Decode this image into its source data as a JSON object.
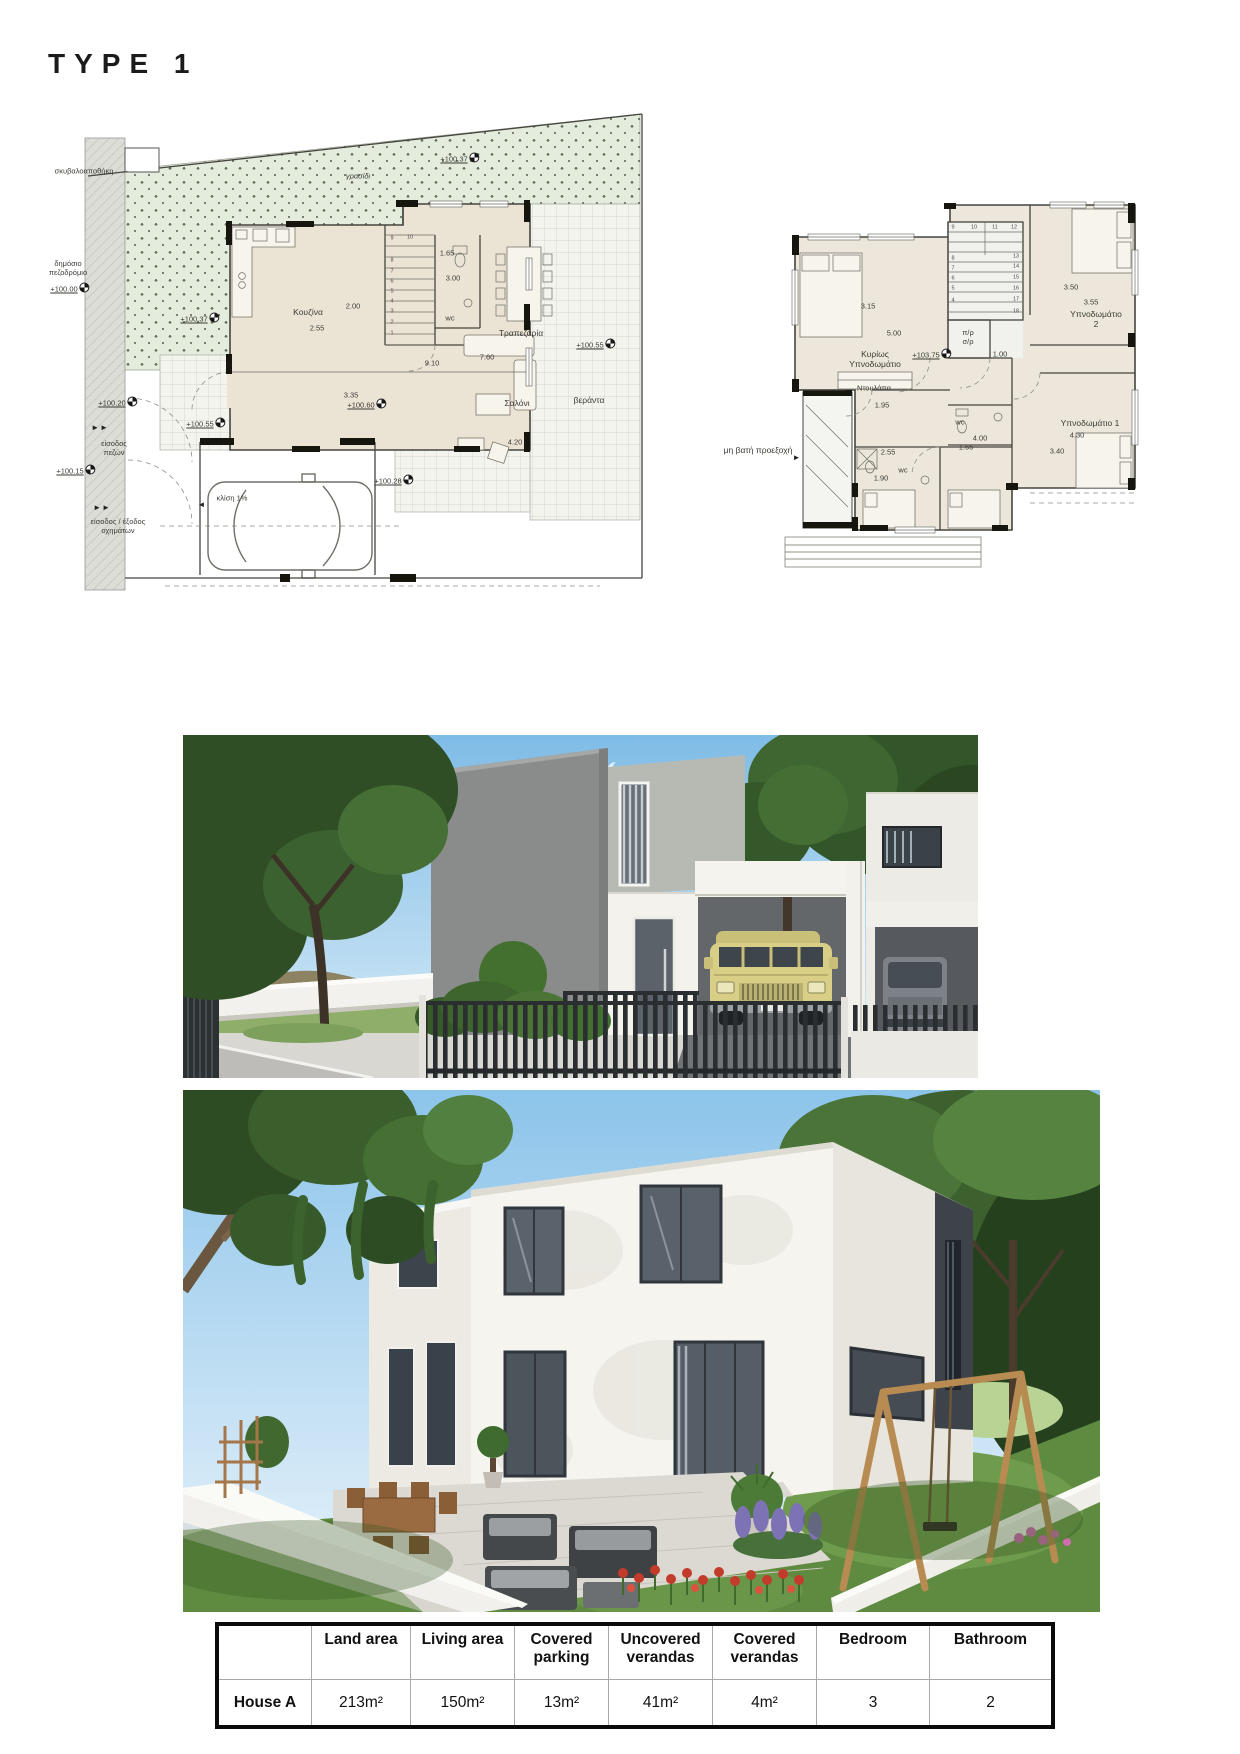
{
  "title": "TYPE 1",
  "colors": {
    "grass_fill": "#e3ecdd",
    "plan_floor": "#ebe4d5",
    "sidewalk_gray": "#ddddd8",
    "sky_top": "#7fbce6",
    "sky_bottom": "#d9ecf8",
    "facade_gray": "#898c8b",
    "facade_white": "#f3f2ed",
    "suv_yellow": "#d8ce85",
    "fence_dark": "#2a2e31",
    "lawn_green": "#5e8b40",
    "tulip_red": "#c33b2b",
    "lavender_purple": "#7d72b4",
    "table_border": "#0a0a0a"
  },
  "icons": {
    "level_marker": "quartered-circle"
  },
  "plans": {
    "ground": {
      "annotations": [
        {
          "t": "σκυβαλοαποθήκη",
          "x": 44,
          "y": 63
        },
        {
          "t": "→",
          "x": 86,
          "y": 63,
          "cls": "arr"
        },
        {
          "t": "δημόσιο\nπεζοδρόμιο",
          "x": 28,
          "y": 160
        },
        {
          "t": "+100.00",
          "x": 30,
          "y": 180,
          "lvl": true
        },
        {
          "t": "+100.37",
          "x": 160,
          "y": 210,
          "lvl": true
        },
        {
          "t": "γρασίδι",
          "x": 318,
          "y": 68,
          "cls": "t7i"
        },
        {
          "t": "+100.37",
          "x": 420,
          "y": 50,
          "lvl": true
        },
        {
          "t": "+100.20",
          "x": 78,
          "y": 294,
          "lvl": true
        },
        {
          "t": "►►",
          "x": 60,
          "y": 320,
          "cls": "arr"
        },
        {
          "t": "είσοδος\nπεζών",
          "x": 74,
          "y": 340
        },
        {
          "t": "+100.15",
          "x": 36,
          "y": 362,
          "lvl": true
        },
        {
          "t": "►►",
          "x": 62,
          "y": 400,
          "cls": "arr"
        },
        {
          "t": "είσοδος / έξοδος\nοχημάτων",
          "x": 78,
          "y": 418
        },
        {
          "t": "Κουζίνα",
          "x": 268,
          "y": 204,
          "cls": "t8"
        },
        {
          "t": "2.55",
          "x": 277,
          "y": 220
        },
        {
          "t": "2.00",
          "x": 313,
          "y": 198
        },
        {
          "t": "1.65",
          "x": 407,
          "y": 145
        },
        {
          "t": "3.00",
          "x": 413,
          "y": 170
        },
        {
          "t": "wc",
          "x": 410,
          "y": 210
        },
        {
          "t": "Τραπεζαρία",
          "x": 481,
          "y": 225,
          "cls": "t8"
        },
        {
          "t": "9.10",
          "x": 392,
          "y": 255
        },
        {
          "t": "7.60",
          "x": 447,
          "y": 249
        },
        {
          "t": "3.35",
          "x": 311,
          "y": 287
        },
        {
          "t": "+100.60",
          "x": 327,
          "y": 296,
          "lvl": true
        },
        {
          "t": "Σαλόνι",
          "x": 477,
          "y": 295,
          "cls": "t8"
        },
        {
          "t": "4.20",
          "x": 475,
          "y": 334
        },
        {
          "t": "+100.55",
          "x": 556,
          "y": 236,
          "lvl": true
        },
        {
          "t": "βεράντα",
          "x": 549,
          "y": 292,
          "cls": "t8"
        },
        {
          "t": "+100.55",
          "x": 166,
          "y": 315,
          "lvl": true
        },
        {
          "t": "+100.28",
          "x": 354,
          "y": 372,
          "lvl": true
        },
        {
          "t": "κλίση 1%",
          "x": 192,
          "y": 390
        },
        {
          "t": "◄",
          "x": 162,
          "y": 397,
          "cls": "arr"
        },
        {
          "t": "9",
          "x": 352,
          "y": 131,
          "cls": "t5"
        },
        {
          "t": "10",
          "x": 370,
          "y": 130,
          "cls": "t5"
        },
        {
          "t": "8",
          "x": 352,
          "y": 153,
          "cls": "t5"
        },
        {
          "t": "7",
          "x": 352,
          "y": 164,
          "cls": "t5"
        },
        {
          "t": "6",
          "x": 352,
          "y": 174,
          "cls": "t5"
        },
        {
          "t": "5",
          "x": 352,
          "y": 184,
          "cls": "t5"
        },
        {
          "t": "4",
          "x": 352,
          "y": 194,
          "cls": "t5"
        },
        {
          "t": "3",
          "x": 352,
          "y": 204,
          "cls": "t5"
        },
        {
          "t": "2",
          "x": 352,
          "y": 215,
          "cls": "t5"
        },
        {
          "t": "1",
          "x": 352,
          "y": 226,
          "cls": "t5"
        }
      ]
    },
    "first": {
      "annotations": [
        {
          "t": "3.15",
          "x": 168,
          "y": 111
        },
        {
          "t": "5.00",
          "x": 194,
          "y": 138
        },
        {
          "t": "Κυρίως\nΥπνοδωμάτιο",
          "x": 175,
          "y": 164,
          "cls": "t8"
        },
        {
          "t": "π/ρ\nσ/ρ",
          "x": 268,
          "y": 142
        },
        {
          "t": "+103.75",
          "x": 232,
          "y": 159,
          "lvl": true
        },
        {
          "t": "1.00",
          "x": 300,
          "y": 159
        },
        {
          "t": "3.50",
          "x": 371,
          "y": 92
        },
        {
          "t": "3.55",
          "x": 391,
          "y": 107
        },
        {
          "t": "Υπνοδωμάτιο 2",
          "x": 396,
          "y": 124,
          "cls": "t8"
        },
        {
          "t": "Ντουλάπα",
          "x": 174,
          "y": 193
        },
        {
          "t": "1.95",
          "x": 182,
          "y": 210
        },
        {
          "t": "wc",
          "x": 260,
          "y": 227
        },
        {
          "t": "4.00",
          "x": 280,
          "y": 243
        },
        {
          "t": "1.65",
          "x": 266,
          "y": 252
        },
        {
          "t": "2.55",
          "x": 188,
          "y": 257
        },
        {
          "t": "wc",
          "x": 203,
          "y": 275
        },
        {
          "t": "1.90",
          "x": 181,
          "y": 283
        },
        {
          "t": "Υπνοδωμάτιο 1",
          "x": 390,
          "y": 228,
          "cls": "t8"
        },
        {
          "t": "4.30",
          "x": 377,
          "y": 240
        },
        {
          "t": "3.40",
          "x": 357,
          "y": 256
        },
        {
          "t": "μη βατή προεξοχή",
          "x": 58,
          "y": 255,
          "cls": "t8"
        },
        {
          "t": "►",
          "x": 97,
          "y": 263,
          "cls": "arr"
        },
        {
          "t": "9",
          "x": 253,
          "y": 33,
          "cls": "t5"
        },
        {
          "t": "10",
          "x": 274,
          "y": 33,
          "cls": "t5"
        },
        {
          "t": "11",
          "x": 295,
          "y": 33,
          "cls": "t5"
        },
        {
          "t": "12",
          "x": 314,
          "y": 33,
          "cls": "t5"
        },
        {
          "t": "8",
          "x": 253,
          "y": 64,
          "cls": "t5"
        },
        {
          "t": "7",
          "x": 253,
          "y": 74,
          "cls": "t5"
        },
        {
          "t": "6",
          "x": 253,
          "y": 84,
          "cls": "t5"
        },
        {
          "t": "5",
          "x": 253,
          "y": 94,
          "cls": "t5"
        },
        {
          "t": "4",
          "x": 253,
          "y": 106,
          "cls": "t5"
        },
        {
          "t": "13",
          "x": 316,
          "y": 62,
          "cls": "t5"
        },
        {
          "t": "14",
          "x": 316,
          "y": 72,
          "cls": "t5"
        },
        {
          "t": "15",
          "x": 316,
          "y": 83,
          "cls": "t5"
        },
        {
          "t": "16",
          "x": 316,
          "y": 94,
          "cls": "t5"
        },
        {
          "t": "17",
          "x": 316,
          "y": 105,
          "cls": "t5"
        },
        {
          "t": "18",
          "x": 316,
          "y": 117,
          "cls": "t5"
        }
      ]
    }
  },
  "table": {
    "headers": [
      "",
      "Land area",
      "Living area",
      "Covered parking",
      "Uncovered verandas",
      "Covered verandas",
      "Bedroom",
      "Bathroom"
    ],
    "rows": [
      {
        "label": "House A",
        "values": [
          "213m²",
          "150m²",
          "13m²",
          "41m²",
          "4m²",
          "3",
          "2"
        ]
      }
    ]
  }
}
